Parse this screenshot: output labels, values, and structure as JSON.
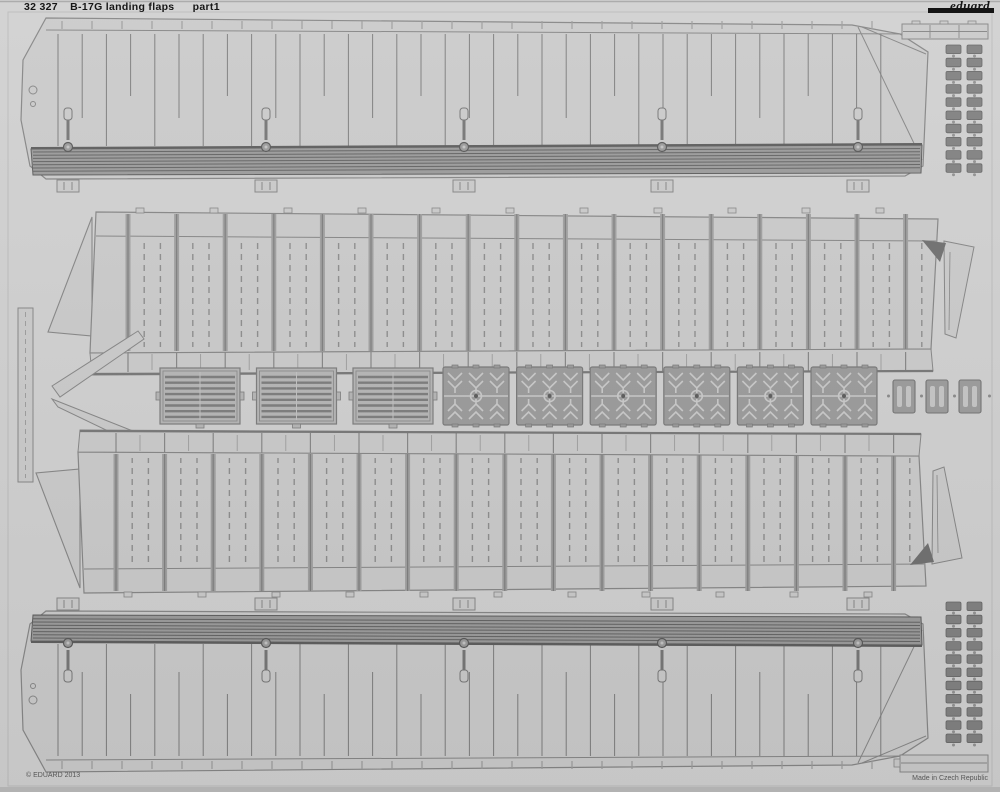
{
  "header": {
    "catalog_number": "32 327",
    "title": "B-17G landing flaps",
    "part_label": "part1",
    "brand": "eduard"
  },
  "footer": {
    "copyright": "© EDUARD 2013",
    "made_in": "Made in Czech Republic"
  },
  "colors": {
    "background": "#d1d1d1",
    "part": "#cbcbcb",
    "outline": "#878787",
    "outline_soft": "#9d9d9d",
    "band": "#9c9c9c",
    "band_line": "#646464",
    "band_edge": "#5e5e5e",
    "dark": "#717171",
    "ladder_block": "#828282",
    "ladder_edge": "#666666",
    "ladder_dot": "#929292",
    "grille": "#b6b6b6",
    "grille_line": "#7d7d7d",
    "hinge": "#9c9c9c",
    "hinge_edge": "#7a7a7a",
    "hinge_light": "#cacaca",
    "hinge_dot": "#5c5c5c",
    "plate": "#9c9c9c",
    "plate_slot": "#c6c6c6",
    "border": "#bcbcbc",
    "text": "#161616",
    "text_soft": "#565656",
    "logo_bar": "#141414",
    "bottom_edge": "#b2b2b2"
  },
  "fret": {
    "flap_skins": 2,
    "flap_frames": 2,
    "grille_plates": 3,
    "hinge_brackets": 6,
    "small_plates": 3,
    "rivet_strips_top": 2,
    "rivet_strips_bottom": 2,
    "end_strips": 2,
    "trim_wedges": 2,
    "spar_strips": 1,
    "skin_ribs_per_flap": 35,
    "frame_bays_per_flap": 17,
    "skin_anchor_fittings": 5
  }
}
